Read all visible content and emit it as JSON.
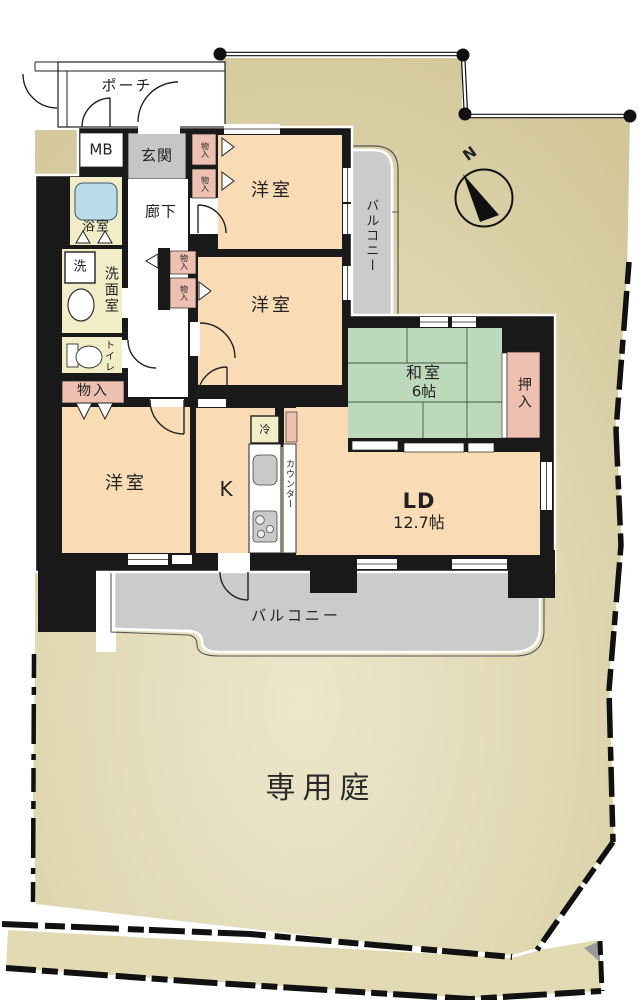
{
  "floorplan": {
    "compass_label": "N",
    "labels": {
      "porch": "ポーチ",
      "meter_box": "MB",
      "entrance": "玄関",
      "hallway": "廊下",
      "bathroom": "浴室",
      "washer": "洗",
      "washroom": "洗面室",
      "toilet": "トイレ",
      "storage": "物入",
      "western_room": "洋室",
      "japanese_room": "和室",
      "japanese_room_size": "6帖",
      "closet": "押入",
      "kitchen": "K",
      "counter": "カウンター",
      "fridge": "冷",
      "living_dining": "LD",
      "living_dining_size": "12.7帖",
      "balcony": "バルコニー",
      "private_garden": "専用庭"
    },
    "colors": {
      "wall": "#191919",
      "room-peach": "#f9dcb5",
      "room-green": "#bdd9bc",
      "room-pink": "#eec0b1",
      "room-cream": "#f1edc6",
      "tub-blue": "#badee9",
      "entry-gray": "#c6c6c6",
      "balcony-gray": "#cccbcb",
      "garden-dark": "#d3c79a",
      "garden-mid": "#e0d8b2",
      "garden-light": "#ece6cb",
      "line": "#222222"
    }
  }
}
